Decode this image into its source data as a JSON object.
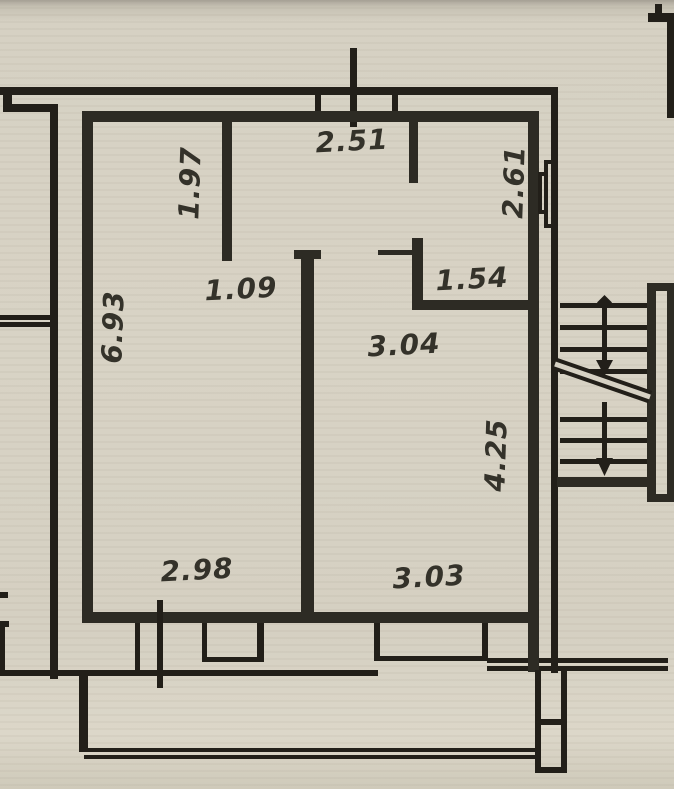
{
  "document": {
    "kind": "apartment floor plan (photographed blueprint)",
    "units_note": "dimensions in meters"
  },
  "colors": {
    "paper": "#d7d2c4",
    "ink_thin": "#221f19",
    "ink_thick": "#2d2b24",
    "label_text": "#34322a"
  },
  "dimensions": {
    "top_window_width": "2.51",
    "left_partition_length": "1.97",
    "right_room_height": "2.61",
    "partition_gap": "1.09",
    "right_room_width": "1.54",
    "left_wall_length": "6.93",
    "main_room_width_upper": "3.04",
    "right_wall_lower_length": "4.25",
    "left_room_bottom_width": "2.98",
    "right_room_bottom_width": "3.03"
  },
  "stairs": {
    "flights": 2,
    "arrow_direction": "down",
    "has_break_line": true,
    "start_marker": "diamond-node"
  },
  "features": {
    "window_bays_bottom": 2,
    "balcony_railing": true,
    "wall_niche_right": true,
    "door_opening_right_room": true
  }
}
